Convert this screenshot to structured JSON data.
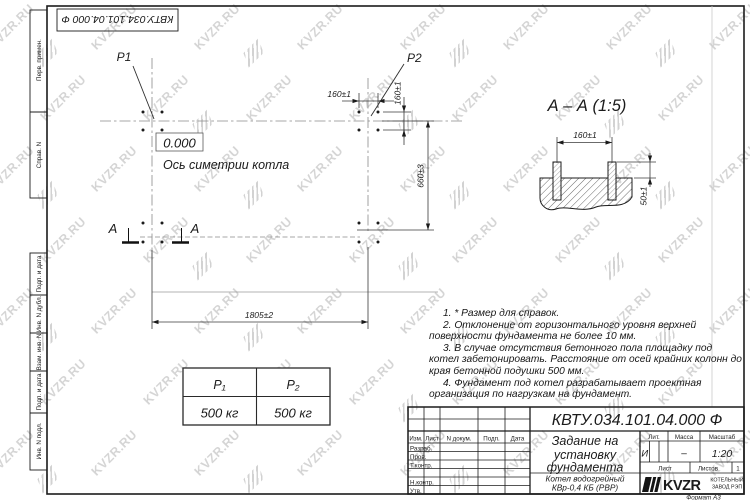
{
  "watermark": {
    "text": "KVZR.RU"
  },
  "top_stamp": {
    "designation": "КВТУ.034.101.04.000 Ф"
  },
  "side_column": {
    "items": [
      "Перв. примен.",
      "Справ. N",
      "Подп. и дата",
      "Инв. N дубл.",
      "Взам. инв. N",
      "Подп. и дата",
      "Инв. N подл."
    ]
  },
  "plan": {
    "p1_label": "P1",
    "p2_label": "P2",
    "level_mark": "0.000",
    "axis_label": "Ось симетрии котла",
    "dim_bolt_spacing_h": "160±1",
    "dim_bolt_spacing_v": "160±1",
    "dim_width": "660±3",
    "dim_length": "1805±2",
    "cut_letter_left": "А",
    "cut_letter_right": "А"
  },
  "section": {
    "title": "А – А (1:5)",
    "dim_bolt_spacing": "160±1",
    "dim_bolt_height": "50±1"
  },
  "notes": [
    "1. * Размер для справок.",
    "2. Отклонение от горизонтального уровня верхней поверхности фундамента не более 10 мм.",
    "3. В случае отсутствия бетонного пола площадку под котел забетонировать. Расстояние от осей крайних колонн до края бетонной подушки 500 мм.",
    "4. Фундамент под котел разрабатывает проектная организация по нагрузкам на фундамент."
  ],
  "load_table": {
    "headers": [
      "P₁",
      "P₂"
    ],
    "values": [
      "500 кг",
      "500 кг"
    ]
  },
  "title_block": {
    "designation": "КВТУ.034.101.04.000 Ф",
    "title_lines": [
      "Задание на",
      "установку",
      "фундамента"
    ],
    "product_lines": [
      "Котел водогрейный",
      "КВр-0,4 КБ (РВР)"
    ],
    "header_cells": [
      "Изм.",
      "Лист",
      "N докум.",
      "Подп.",
      "Дата"
    ],
    "row_labels": [
      "Разраб.",
      "Пров.",
      "Т.контр.",
      "Н.контр.",
      "Утв."
    ],
    "lit_label": "Лит.",
    "mass_label": "Масса",
    "scale_label": "Масштаб",
    "lit_value": "И",
    "mass_value": "–",
    "scale_value": "1:20",
    "sheet_label": "Лист",
    "sheets_label": "Листов",
    "sheets_value": "1",
    "logo_text": "KVZR",
    "logo_lines": [
      "КОТЕЛЬНЫЙ",
      "ЗАВОД РЭП"
    ],
    "format_label": "Формат А3"
  }
}
